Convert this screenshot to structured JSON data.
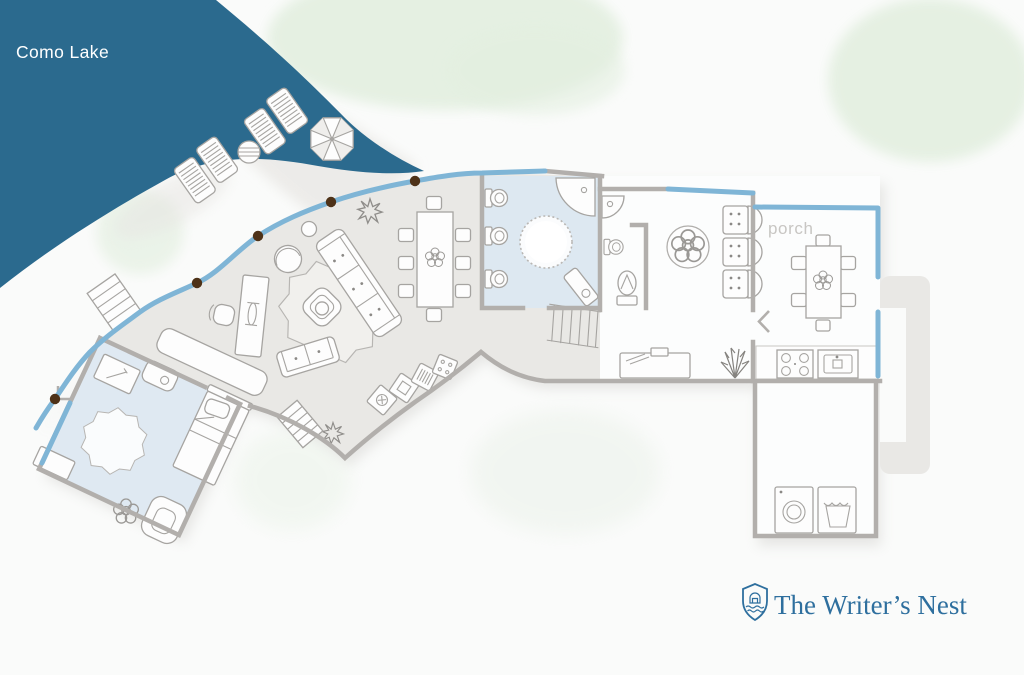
{
  "labels": {
    "lake": "Como Lake",
    "porch": "porch"
  },
  "branding": {
    "name": "The Writer’s Nest",
    "icon": "shield-house-icon"
  },
  "colors": {
    "lake": "#2b6a8e",
    "window_blue": "#7fb5d6",
    "wall_gray": "#b2afac",
    "floor_gray": "#e9e8e5",
    "floor_blue": "#dde8f1",
    "foliage_green": "#e3efe0",
    "post_brown": "#4e3218",
    "brand_blue": "#2e6f9e",
    "porch_label_gray": "#c8c6c3"
  },
  "floorplan": {
    "rooms": [
      "living-lounge",
      "dining-area",
      "kitchen",
      "main-bathroom",
      "ensuite-bathroom",
      "sitting-room",
      "porch",
      "hallway",
      "laundry-room",
      "bedroom"
    ],
    "window_posts": 5,
    "outdoor_icons": [
      "sun-lounger",
      "sun-lounger",
      "sun-lounger",
      "sun-lounger",
      "parasol",
      "round-side-table",
      "outdoor-steps",
      "shore-steps",
      "trees"
    ]
  }
}
